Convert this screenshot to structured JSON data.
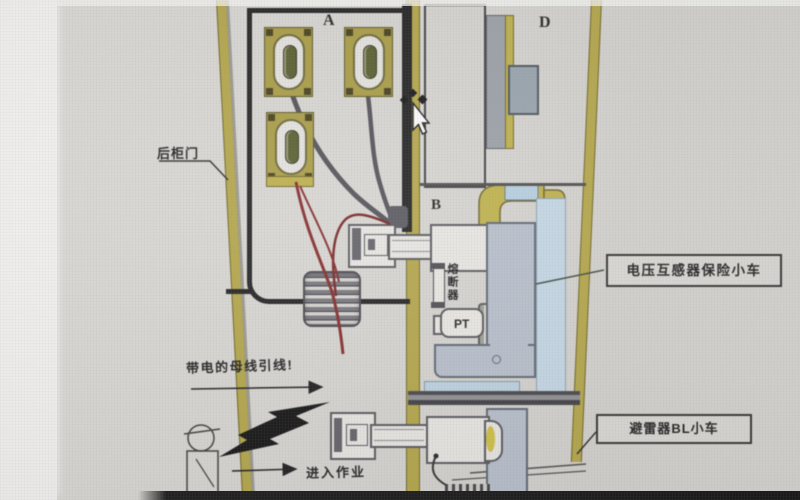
{
  "scene": {
    "rear_door_label": "后柜门",
    "compartment_a": "A",
    "compartment_b": "B",
    "compartment_d": "D",
    "fuse_label": "熔断器",
    "pt_label": "PT",
    "busbar_warning": "带电的母线引线!",
    "enter_work": "进入作业",
    "vt_trolley_label": "电压互感器保险小车",
    "arrester_trolley_label": "避雷器BL小车",
    "colors": {
      "wall_olive": "#b6a63e",
      "panel_blue_gray": "#b7c0cd",
      "light_blue": "#c4d9e9",
      "cable_red": "#8a2424",
      "cable_gray": "#4e4d54",
      "structure_black": "#1d1d1d",
      "highlight_yellow": "#d2c238"
    }
  }
}
